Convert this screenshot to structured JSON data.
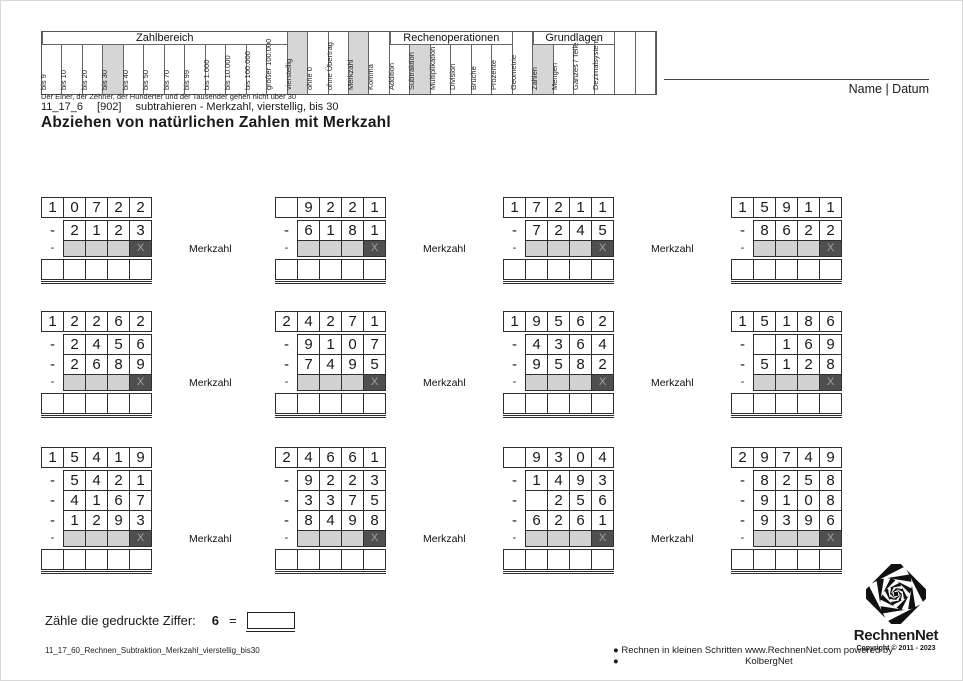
{
  "colors": {
    "highlight": "#d6d6d6",
    "cell_gray": "#d2d2d2",
    "cell_dark": "#4f4f4f",
    "cell_dark_text": "#a3a3a3",
    "border": "#2e2e2e"
  },
  "header": {
    "name_datum": "Name | Datum",
    "note": "Der Einer, der Zehner, der Hunderter und der Tausender gehen nicht über 30",
    "groups": [
      {
        "label": "Zahlbereich",
        "start": 0,
        "span": 12
      },
      {
        "label": "Rechenoperationen",
        "start": 17,
        "span": 6
      },
      {
        "label": "Grundlagen",
        "start": 24,
        "span": 4
      }
    ],
    "columns": [
      {
        "label": "bis 9",
        "grouped": true,
        "hl": false
      },
      {
        "label": "bis 10",
        "grouped": true,
        "hl": false
      },
      {
        "label": "bis 20",
        "grouped": true,
        "hl": false
      },
      {
        "label": "bis 30",
        "grouped": true,
        "hl": true
      },
      {
        "label": "bis 40",
        "grouped": true,
        "hl": false
      },
      {
        "label": "bis 50",
        "grouped": true,
        "hl": false
      },
      {
        "label": "bis 70",
        "grouped": true,
        "hl": false
      },
      {
        "label": "bis 99",
        "grouped": true,
        "hl": false
      },
      {
        "label": "bis 1.000",
        "grouped": true,
        "hl": false
      },
      {
        "label": "bis 10.000",
        "grouped": true,
        "hl": false
      },
      {
        "label": "bis 100.000",
        "grouped": true,
        "hl": false
      },
      {
        "label": "größer 100.000",
        "grouped": true,
        "hl": false
      },
      {
        "label": "vierstellig",
        "grouped": false,
        "hl": true
      },
      {
        "label": "ohne 0",
        "grouped": false,
        "hl": false
      },
      {
        "label": "ohne Übertrag",
        "grouped": false,
        "hl": false
      },
      {
        "label": "Merkzahl",
        "grouped": false,
        "hl": true
      },
      {
        "label": "Komma",
        "grouped": false,
        "hl": false
      },
      {
        "label": "Addition",
        "grouped": true,
        "hl": false
      },
      {
        "label": "Subtraktion",
        "grouped": true,
        "hl": true
      },
      {
        "label": "Multiplikation",
        "grouped": true,
        "hl": false
      },
      {
        "label": "Division",
        "grouped": true,
        "hl": false
      },
      {
        "label": "Brüche",
        "grouped": true,
        "hl": false
      },
      {
        "label": "Prozente",
        "grouped": true,
        "hl": false
      },
      {
        "label": "Geometrie",
        "grouped": false,
        "hl": false
      },
      {
        "label": "Zahlen",
        "grouped": true,
        "hl": true
      },
      {
        "label": "Mengen",
        "grouped": true,
        "hl": false
      },
      {
        "label": "Ganzes / Teile",
        "grouped": true,
        "hl": false
      },
      {
        "label": "Dezimalsystem",
        "grouped": true,
        "hl": false
      },
      {
        "label": "",
        "grouped": false,
        "hl": false
      },
      {
        "label": "",
        "grouped": false,
        "hl": false
      }
    ]
  },
  "meta": {
    "code": "11_17_6",
    "ref": "[902]",
    "subtitle": "subtrahieren - Merkzahl, vierstellig, bis 30",
    "title": "Abziehen von natürlichen Zahlen mit Merkzahl"
  },
  "worksheet": {
    "merkzahl_label": "Merkzahl",
    "merk_x": "X",
    "rows": [
      [
        {
          "minuend": [
            "1",
            "0",
            "7",
            "2",
            "2"
          ],
          "subtrahends": [
            [
              "2",
              "1",
              "2",
              "3"
            ]
          ],
          "label": true
        },
        {
          "minuend": [
            "",
            "9",
            "2",
            "2",
            "1"
          ],
          "subtrahends": [
            [
              "6",
              "1",
              "8",
              "1"
            ]
          ],
          "label": true
        },
        {
          "minuend": [
            "1",
            "7",
            "2",
            "1",
            "1"
          ],
          "subtrahends": [
            [
              "7",
              "2",
              "4",
              "5"
            ]
          ],
          "label": true
        },
        {
          "minuend": [
            "1",
            "5",
            "9",
            "1",
            "1"
          ],
          "subtrahends": [
            [
              "8",
              "6",
              "2",
              "2"
            ]
          ],
          "label": false
        }
      ],
      [
        {
          "minuend": [
            "1",
            "2",
            "2",
            "6",
            "2"
          ],
          "subtrahends": [
            [
              "2",
              "4",
              "5",
              "6"
            ],
            [
              "2",
              "6",
              "8",
              "9"
            ]
          ],
          "label": true
        },
        {
          "minuend": [
            "2",
            "4",
            "2",
            "7",
            "1"
          ],
          "subtrahends": [
            [
              "9",
              "1",
              "0",
              "7"
            ],
            [
              "7",
              "4",
              "9",
              "5"
            ]
          ],
          "label": true
        },
        {
          "minuend": [
            "1",
            "9",
            "5",
            "6",
            "2"
          ],
          "subtrahends": [
            [
              "4",
              "3",
              "6",
              "4"
            ],
            [
              "9",
              "5",
              "8",
              "2"
            ]
          ],
          "label": true
        },
        {
          "minuend": [
            "1",
            "5",
            "1",
            "8",
            "6"
          ],
          "subtrahends": [
            [
              "",
              "1",
              "6",
              "9"
            ],
            [
              "5",
              "1",
              "2",
              "8"
            ]
          ],
          "label": false
        }
      ],
      [
        {
          "minuend": [
            "1",
            "5",
            "4",
            "1",
            "9"
          ],
          "subtrahends": [
            [
              "5",
              "4",
              "2",
              "1"
            ],
            [
              "4",
              "1",
              "6",
              "7"
            ],
            [
              "1",
              "2",
              "9",
              "3"
            ]
          ],
          "label": true
        },
        {
          "minuend": [
            "2",
            "4",
            "6",
            "6",
            "1"
          ],
          "subtrahends": [
            [
              "9",
              "2",
              "2",
              "3"
            ],
            [
              "3",
              "3",
              "7",
              "5"
            ],
            [
              "8",
              "4",
              "9",
              "8"
            ]
          ],
          "label": true
        },
        {
          "minuend": [
            "",
            "9",
            "3",
            "0",
            "4"
          ],
          "subtrahends": [
            [
              "1",
              "4",
              "9",
              "3"
            ],
            [
              "",
              "2",
              "5",
              "6"
            ],
            [
              "6",
              "2",
              "6",
              "1"
            ]
          ],
          "label": true
        },
        {
          "minuend": [
            "2",
            "9",
            "7",
            "4",
            "9"
          ],
          "subtrahends": [
            [
              "8",
              "2",
              "5",
              "8"
            ],
            [
              "9",
              "1",
              "0",
              "8"
            ],
            [
              "9",
              "3",
              "9",
              "6"
            ]
          ],
          "label": false
        }
      ]
    ]
  },
  "task": {
    "prompt": "Zähle die gedruckte Ziffer:",
    "digit": "6",
    "equals": "="
  },
  "footer": {
    "filename": "11_17_60_Rechnen_Subtraktion_Merkzahl_vierstellig_bis30",
    "slogan": "● Rechnen in kleinen Schritten ●",
    "website": "www.RechnenNet.com powered by KolbergNet",
    "brand": "RechnenNet",
    "copyright": "Copyright © 2011 - 2023"
  }
}
